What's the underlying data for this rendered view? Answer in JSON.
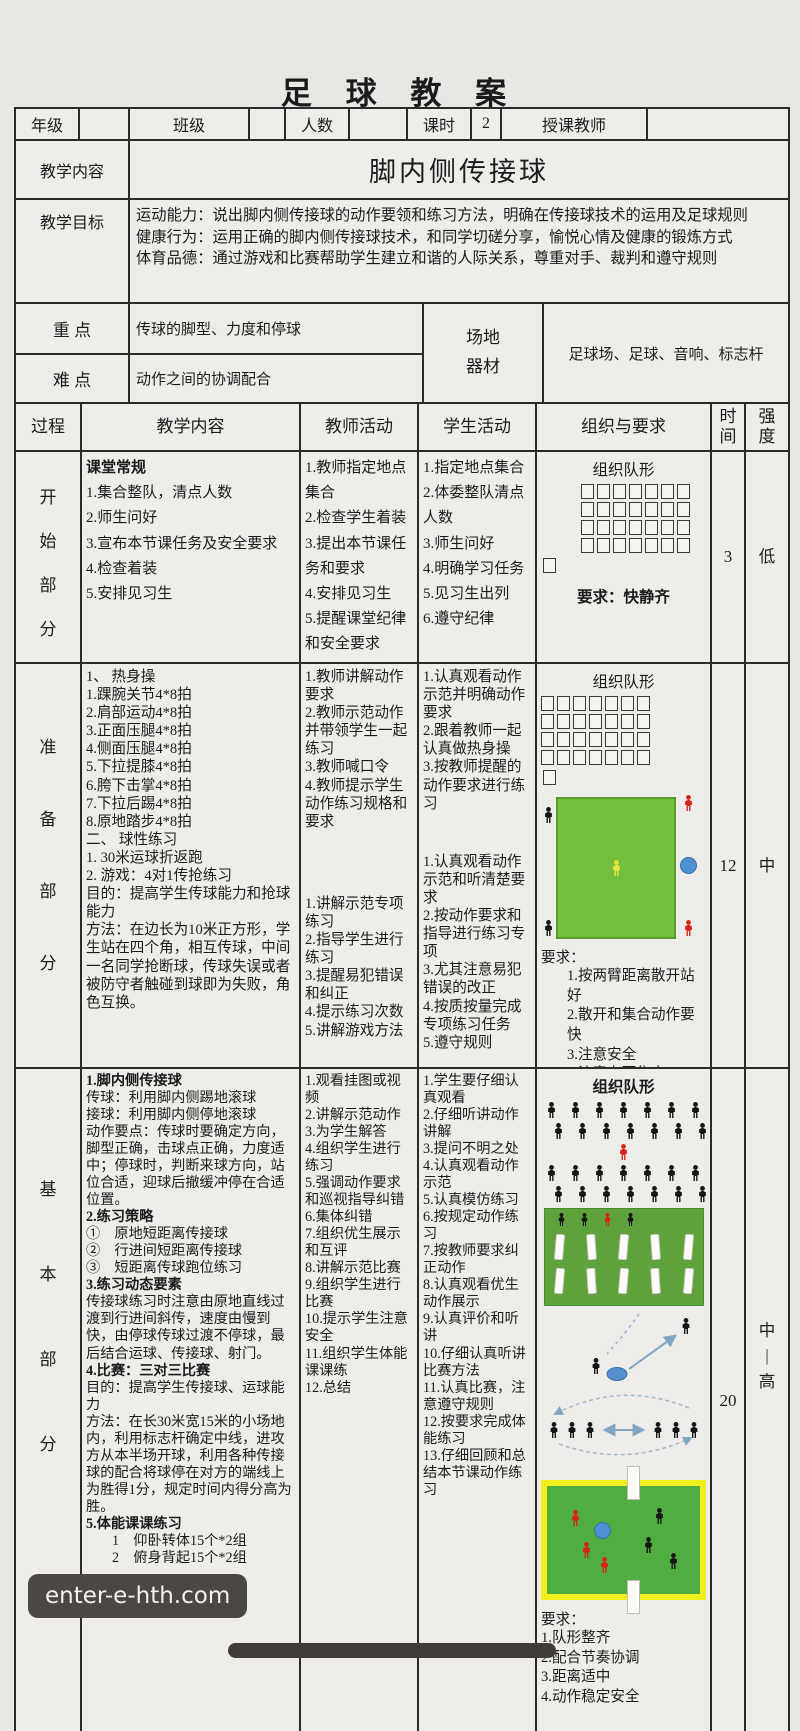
{
  "title": "足 球 教 案",
  "watermark": "enter-e-hth.com",
  "info": {
    "grade": "年级",
    "class": "班级",
    "count": "人数",
    "period": "课时",
    "period_value": "2",
    "teacher": "授课教师"
  },
  "content": {
    "label": "教学内容",
    "value": "脚内侧传接球"
  },
  "objectives": {
    "label": "教学目标",
    "lines": [
      "运动能力：说出脚内侧传接球的动作要领和练习方法，明确在传接球技术的运用及足球规则",
      "健康行为：运用正确的脚内侧传接球技术，和同学切磋分享，愉悦心情及健康的锻炼方式",
      "体育品德：通过游戏和比赛帮助学生建立和谐的人际关系，尊重对手、裁判和遵守规则"
    ]
  },
  "focus": {
    "label": "重 点",
    "value": "传球的脚型、力度和停球"
  },
  "difficulty": {
    "label": "难 点",
    "value": "动作之间的协调配合"
  },
  "venue": {
    "label": [
      "场地",
      "器材"
    ],
    "value": "足球场、足球、音响、标志杆"
  },
  "grid": {
    "process": "过程",
    "teaching": "教学内容",
    "teacher": "教师活动",
    "student": "学生活动",
    "organization": "组织与要求",
    "time": [
      "时",
      "间"
    ],
    "intensity": [
      "强",
      "度"
    ]
  },
  "sections": {
    "start": {
      "name": [
        "开",
        "始",
        "部",
        "分"
      ],
      "teaching_head": "课堂常规",
      "teaching_items": [
        "1.集合整队，清点人数",
        "2.师生问好",
        "3.宣布本节课任务及安全要求",
        "4.检查着装",
        "5.安排见习生"
      ],
      "teacher_items": [
        "1.教师指定地点集合",
        "2.检查学生着装",
        "3.提出本节课任务和要求",
        "4.安排见习生",
        "5.提醒课堂纪律和安全要求"
      ],
      "student_items": [
        "1.指定地点集合",
        "2.体委整队清点人数",
        "3.师生问好",
        "4.明确学习任务",
        "5.见习生出列",
        "6.遵守纪律"
      ],
      "org": {
        "title": "组织队形",
        "requirement": "要求：快静齐"
      },
      "time": "3",
      "intensity": "低"
    },
    "prep": {
      "name": [
        "准",
        "备",
        "部",
        "分"
      ],
      "teaching_items": [
        "1、 热身操",
        "1.踝腕关节4*8拍",
        "2.肩部运动4*8拍",
        "3.正面压腿4*8拍",
        "4.侧面压腿4*8拍",
        "5.下拉提膝4*8拍",
        "6.胯下击掌4*8拍",
        "7.下拉后踢4*8拍",
        "8.原地踏步4*8拍",
        "二、 球性练习",
        "1. 30米运球折返跑",
        "2. 游戏：4对1传抢练习",
        "目的：提高学生传球能力和抢球能力",
        "方法：在边长为10米正方形，学生站在四个角，相互传球，中间一名同学抢断球，传球失误或者被防守者触碰到球即为失败，角色互换。"
      ],
      "teacher_block1": [
        "1.教师讲解动作要求",
        "2.教师示范动作并带领学生一起练习",
        "3.教师喊口令",
        "4.教师提示学生动作练习规格和要求"
      ],
      "teacher_block2": [
        "1.讲解示范专项练习",
        "2.指导学生进行练习",
        "3.提醒易犯错误和纠正",
        "4.提示练习次数",
        "5.讲解游戏方法"
      ],
      "student_block1": [
        "1.认真观看动作示范并明确动作要求",
        "2.跟着教师一起认真做热身操",
        "3.按教师提醒的动作要求进行练习"
      ],
      "student_block2": [
        "1.认真观看动作示范和听清楚要求",
        "2.按动作要求和指导进行练习专项",
        "3.尤其注意易犯错误的改正",
        "4.按质按量完成专项练习任务",
        "5.遵守规则"
      ],
      "org": {
        "title": "组织队形",
        "req_label": "要求：",
        "req_items": [
          "1.按两臂距离散开站好",
          "2.散开和集合动作要快",
          "3.注意安全",
          "4.注意力要集中"
        ]
      },
      "time": "12",
      "intensity": "中"
    },
    "basic": {
      "name": [
        "基",
        "本",
        "部",
        "分"
      ],
      "teaching": {
        "g1": {
          "head": "1.脚内侧传接球",
          "body": "传球：利用脚内侧踢地滚球\n接球：利用脚内侧停地滚球\n动作要点：传球时要确定方向，脚型正确，击球点正确，力度适中；停球时，判断来球方向，站位合适，迎球后撤缓冲停在合适位置。"
        },
        "g2": {
          "head": "2.练习策略",
          "body": "①　原地短距离传接球\n②　行进间短距离传接球\n③　短距离传球跑位练习"
        },
        "g3": {
          "head": "3.练习动态要素",
          "body": "传接球练习时注意由原地直线过渡到行进间斜传，速度由慢到快，由停球传球过渡不停球，最后结合运球、传接球、射门。"
        },
        "g4": {
          "head": "4.比赛：三对三比赛",
          "body": "目的：提高学生传接球、运球能力\n方法：在长30米宽15米的小场地内，利用标志杆确定中线，进攻方从本半场开球，利用各种传接球的配合将球停在对方的端线上为胜得1分，规定时间内得分高为胜。"
        },
        "g5": {
          "head": "5.体能课课练习",
          "body": "1　仰卧转体15个*2组\n2　俯身背起15个*2组"
        }
      },
      "teacher_items": [
        "1.观看挂图或视频",
        "2.讲解示范动作",
        "3.为学生解答",
        "4.组织学生进行练习",
        "5.强调动作要求和巡视指导纠错",
        "6.集体纠错",
        "7.组织优生展示和互评",
        "8.讲解示范比赛",
        "9.组织学生进行比赛",
        "10.提示学生注意安全",
        "11.组织学生体能课课练",
        "12.总结"
      ],
      "student_items": [
        "1.学生要仔细认真观看",
        "2.仔细听讲动作讲解",
        "3.提问不明之处",
        "4.认真观看动作示范",
        "5.认真模仿练习",
        "6.按规定动作练习",
        "7.按教师要求纠正动作",
        "8.认真观看优生动作展示",
        "9.认真评价和听讲",
        "10.仔细认真听讲比赛方法",
        "11.认真比赛，注意遵守规则",
        "12.按要求完成体能练习",
        "13.仔细回顾和总结本节课动作练习"
      ],
      "org": {
        "title": "组织队形",
        "req_label": "要求：",
        "req_items": [
          "1.队形整齐",
          "2.配合节奏协调",
          "3.距离适中",
          "4.动作稳定安全"
        ]
      },
      "time": "20",
      "intensity": [
        "中",
        "|",
        "高"
      ]
    }
  },
  "diagrams": {
    "start_formation": {
      "rows": [
        7,
        7,
        7,
        7
      ],
      "leader": 1
    },
    "prep_formation": {
      "rows": [
        7,
        7,
        7,
        7
      ],
      "leader": 1
    },
    "basic_crowd": {
      "rows": [
        7,
        7
      ],
      "center": 1,
      "rows2": [
        7,
        7
      ]
    }
  },
  "colors": {
    "practice_field_green": "#72bf3e",
    "poles_field_green": "#5da23b",
    "match_field_green": "#4fae3f",
    "match_border_yellow": "#f2ee1b",
    "ball_blue": "#4f8fd4",
    "figure_red": "#d8231b",
    "figure_yellow": "#e9e23a"
  }
}
